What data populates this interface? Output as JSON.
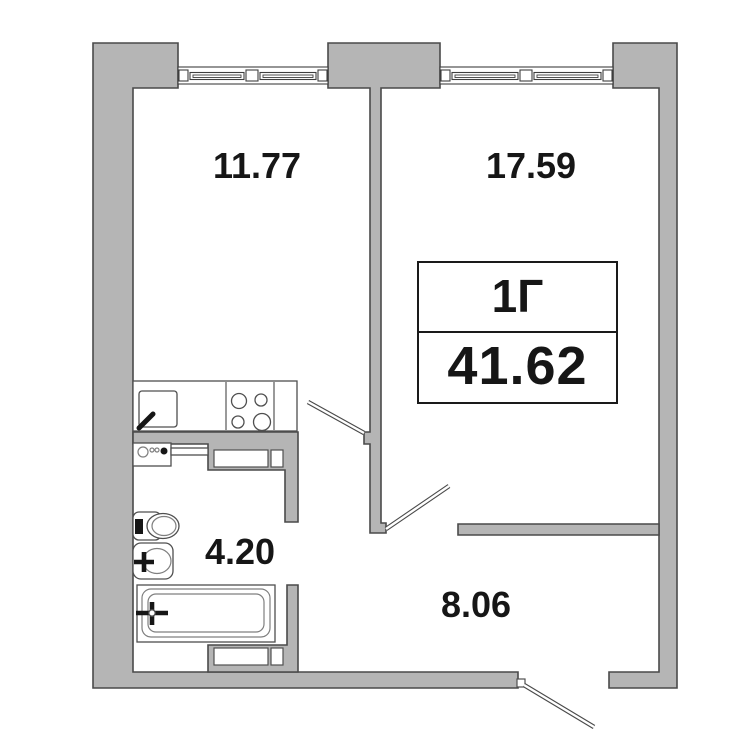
{
  "colors": {
    "bg": "#ffffff",
    "wall_fill": "#b5b5b5",
    "wall_stroke": "#4a4a4a",
    "line": "#4f4f4f",
    "text": "#161616"
  },
  "unit_label": {
    "type": "1Г",
    "total_area": "41.62"
  },
  "rooms": [
    {
      "name": "kitchen-living-room",
      "area": "11.77"
    },
    {
      "name": "bedroom",
      "area": "17.59"
    },
    {
      "name": "bathroom",
      "area": "4.20"
    },
    {
      "name": "hallway",
      "area": "8.06"
    }
  ]
}
